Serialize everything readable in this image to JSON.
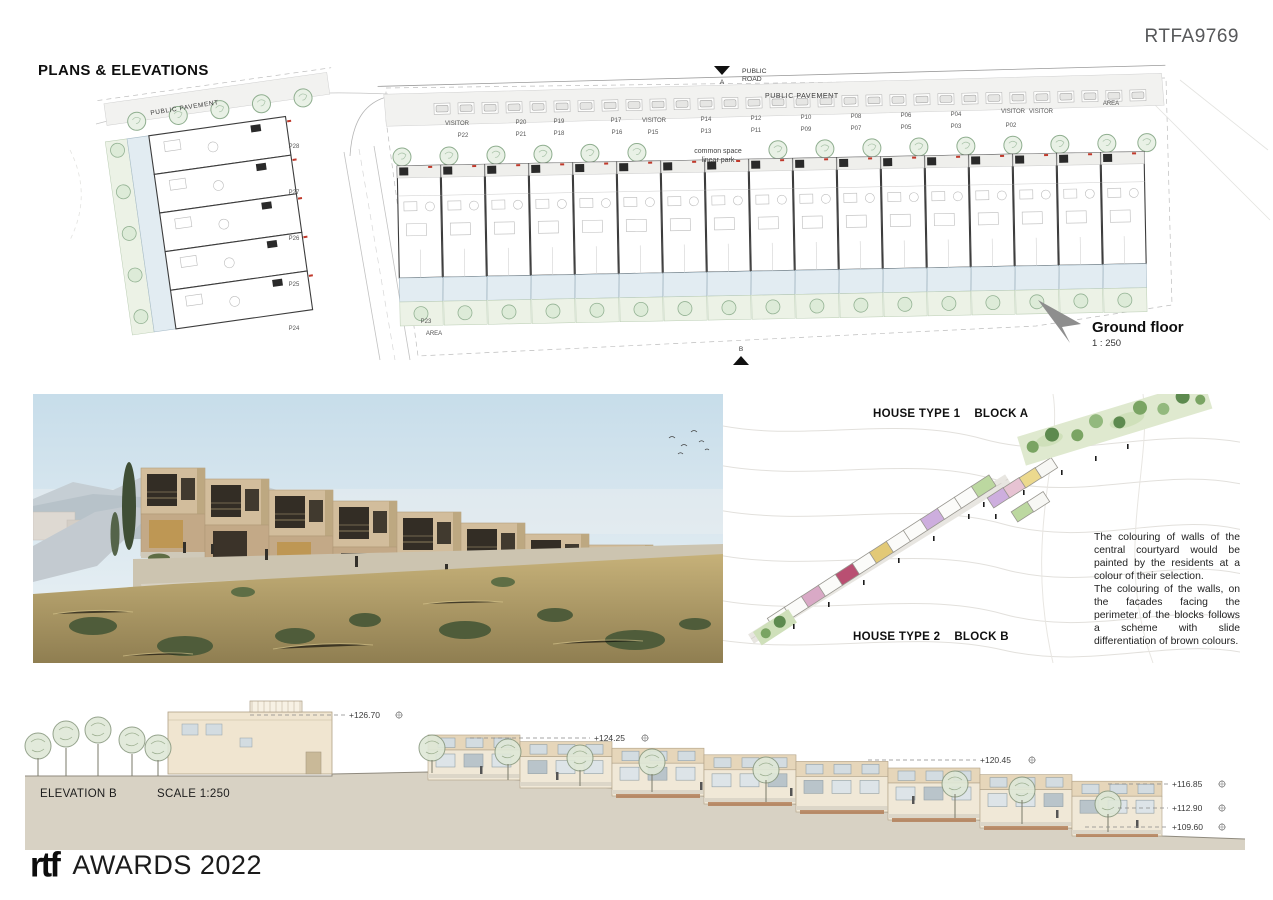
{
  "page": {
    "code": "RTFA9769",
    "title": "PLANS & ELEVATIONS"
  },
  "plan": {
    "public_road_1": "PUBLIC",
    "public_road_2": "ROAD",
    "pavement_top": "PUBLIC PAVEMENT",
    "pavement_left": "PUBLIC PAVEMENT",
    "common_space_1": "common space",
    "common_space_2": "linear park",
    "marker_top": "A",
    "marker_bottom": "B",
    "caption_title": "Ground floor",
    "caption_scale": "1 : 250",
    "parking_top": [
      "VISITOR",
      "P20",
      "P19",
      "P17",
      "VISITOR",
      "P14",
      "P12",
      "P10",
      "P08",
      "P06",
      "P04",
      "VISITOR",
      "VISITOR",
      "AREA"
    ],
    "parking_bottom": [
      "P22",
      "P21",
      "P18",
      "P16",
      "P15",
      "P13",
      "P11",
      "P09",
      "P07",
      "P05",
      "P03",
      "P02"
    ],
    "left_block_labels": [
      "P28",
      "P27",
      "P26",
      "P25",
      "P24"
    ],
    "bottom_left_labels": [
      "P23",
      "AREA"
    ]
  },
  "axon": {
    "type1_label": "HOUSE TYPE 1",
    "type1_block": "BLOCK A",
    "type2_label": "HOUSE TYPE 2",
    "type2_block": "BLOCK B",
    "note_p1": "The colouring of walls of the central courtyard would be painted by the residents at a colour of their selection.",
    "note_p2": "The colouring of the walls, on the facades facing the perimeter of the blocks follows a scheme with slide differentiation of brown colours."
  },
  "elevation": {
    "name": "ELEVATION B",
    "scale": "SCALE 1:250",
    "levels": [
      "+126.70",
      "+124.25",
      "+120.45",
      "+116.85",
      "+112.90",
      "+109.60"
    ]
  },
  "footer": {
    "logo": "rtf",
    "title": "AWARDS 2022"
  },
  "colors": {
    "plan_green": "#8fae8f",
    "plan_blue": "#e2ecf2",
    "render_tan": "#d2bd9c",
    "elevation_tan": "#e6d6ba",
    "red_tick": "#c0392b"
  }
}
